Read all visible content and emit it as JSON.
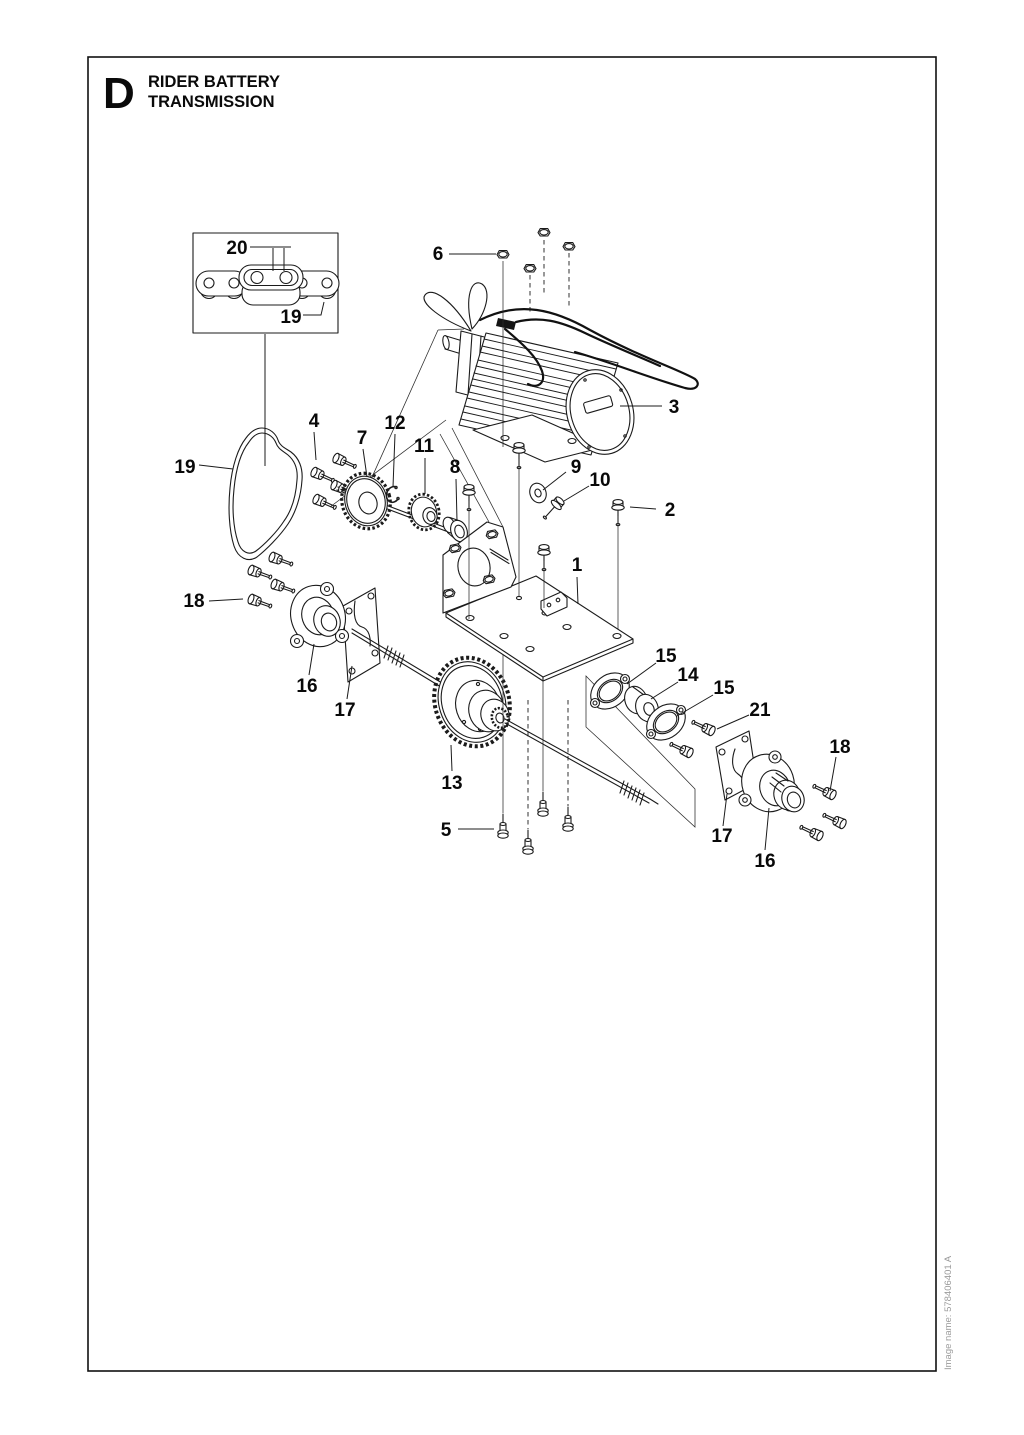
{
  "page": {
    "section_letter": "D",
    "title_line1": "RIDER BATTERY",
    "title_line2": "TRANSMISSION",
    "image_name": "Image name: 578406401 A"
  },
  "callouts": {
    "c20": "20",
    "c19_inset": "19",
    "c19_belt": "19",
    "c6": "6",
    "c3": "3",
    "c4": "4",
    "c7": "7",
    "c12": "12",
    "c11": "11",
    "c8": "8",
    "c9": "9",
    "c10": "10",
    "c2": "2",
    "c1": "1",
    "c18_left": "18",
    "c16_left": "16",
    "c17_left": "17",
    "c13": "13",
    "c15_a": "15",
    "c14": "14",
    "c15_b": "15",
    "c21": "21",
    "c5": "5",
    "c17_right": "17",
    "c16_right": "16",
    "c18_right": "18"
  }
}
